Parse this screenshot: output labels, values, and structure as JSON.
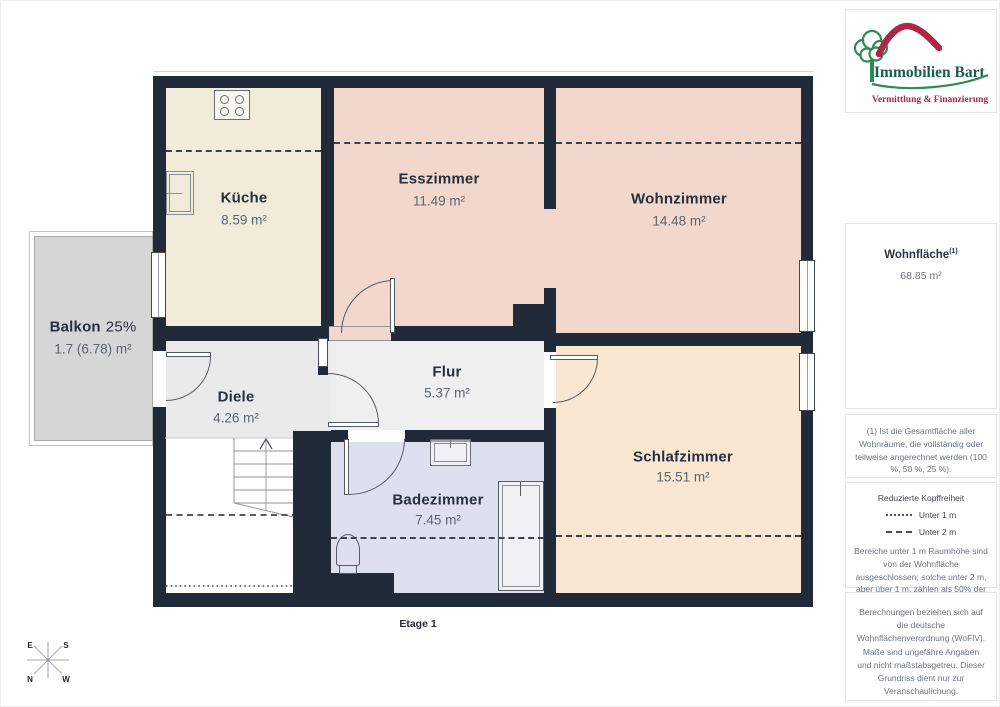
{
  "branding": {
    "name": "Immobilien Bart",
    "tagline": "Vermittlung & Finanzierung"
  },
  "sidebar": {
    "area_label": "Wohnfläche",
    "area_footnote_marker": "(1)",
    "area_value": "68.85 m²",
    "footnote": "(1) Ist die Gesamtfläche aller Wohnräume, die vollständig oder teilweise angerechnet werden (100 %, 50 %, 25 %).",
    "legend": {
      "title": "Reduzierte Kopffreiheit",
      "under_1m": "Unter 1 m",
      "under_2m": "Unter 2 m",
      "body": "Bereiche unter 1 m Raumhöhe sind von der Wohnfläche ausgeschlossen; solche unter 2 m, aber über 1 m, zählen als 50% der Wohnfläche"
    },
    "disclaimer": "Berechnungen beziehen sich auf die deutsche Wohnflächenverordnung (WoFlV). Maße sind ungefähre Angaben und nicht maßstabsgetreu. Dieser Grundriss dient nur zur Veranschaulichung.",
    "brand": "GIRAFFE",
    "brand_bold": "360"
  },
  "floorplan": {
    "floor_label": "Etage 1",
    "compass": {
      "n": "N",
      "e": "E",
      "s": "S",
      "w": "W"
    },
    "rooms": [
      {
        "id": "kueche",
        "name": "Küche",
        "area": "8.59 m²"
      },
      {
        "id": "esszimmer",
        "name": "Esszimmer",
        "area": "11.49 m²"
      },
      {
        "id": "wohnzimmer",
        "name": "Wohnzimmer",
        "area": "14.48 m²"
      },
      {
        "id": "balkon",
        "name": "Balkon",
        "percentage": "25%",
        "area": "1.7 (6.78) m²"
      },
      {
        "id": "diele",
        "name": "Diele",
        "area": "4.26 m²"
      },
      {
        "id": "flur",
        "name": "Flur",
        "area": "5.37 m²"
      },
      {
        "id": "badezimmer",
        "name": "Badezimmer",
        "area": "7.45 m²"
      },
      {
        "id": "schlafzimmer",
        "name": "Schlafzimmer",
        "area": "15.51 m²"
      }
    ]
  },
  "colors": {
    "wall": "#212a38",
    "kueche": "#f1ebd9",
    "esszimmer": "#f2d8cc",
    "wohnzimmer": "#f2d8cc",
    "schlafzimmer": "#fae7d2",
    "badezimmer": "#dce1ed",
    "diele": "#eaeaea",
    "flur": "#efefef",
    "balkon": "#d5d7d6",
    "stairs": "#ffffff",
    "logo_green": "#2e8b55",
    "logo_red": "#ae2746",
    "logo_text": "#1a5d4e"
  }
}
